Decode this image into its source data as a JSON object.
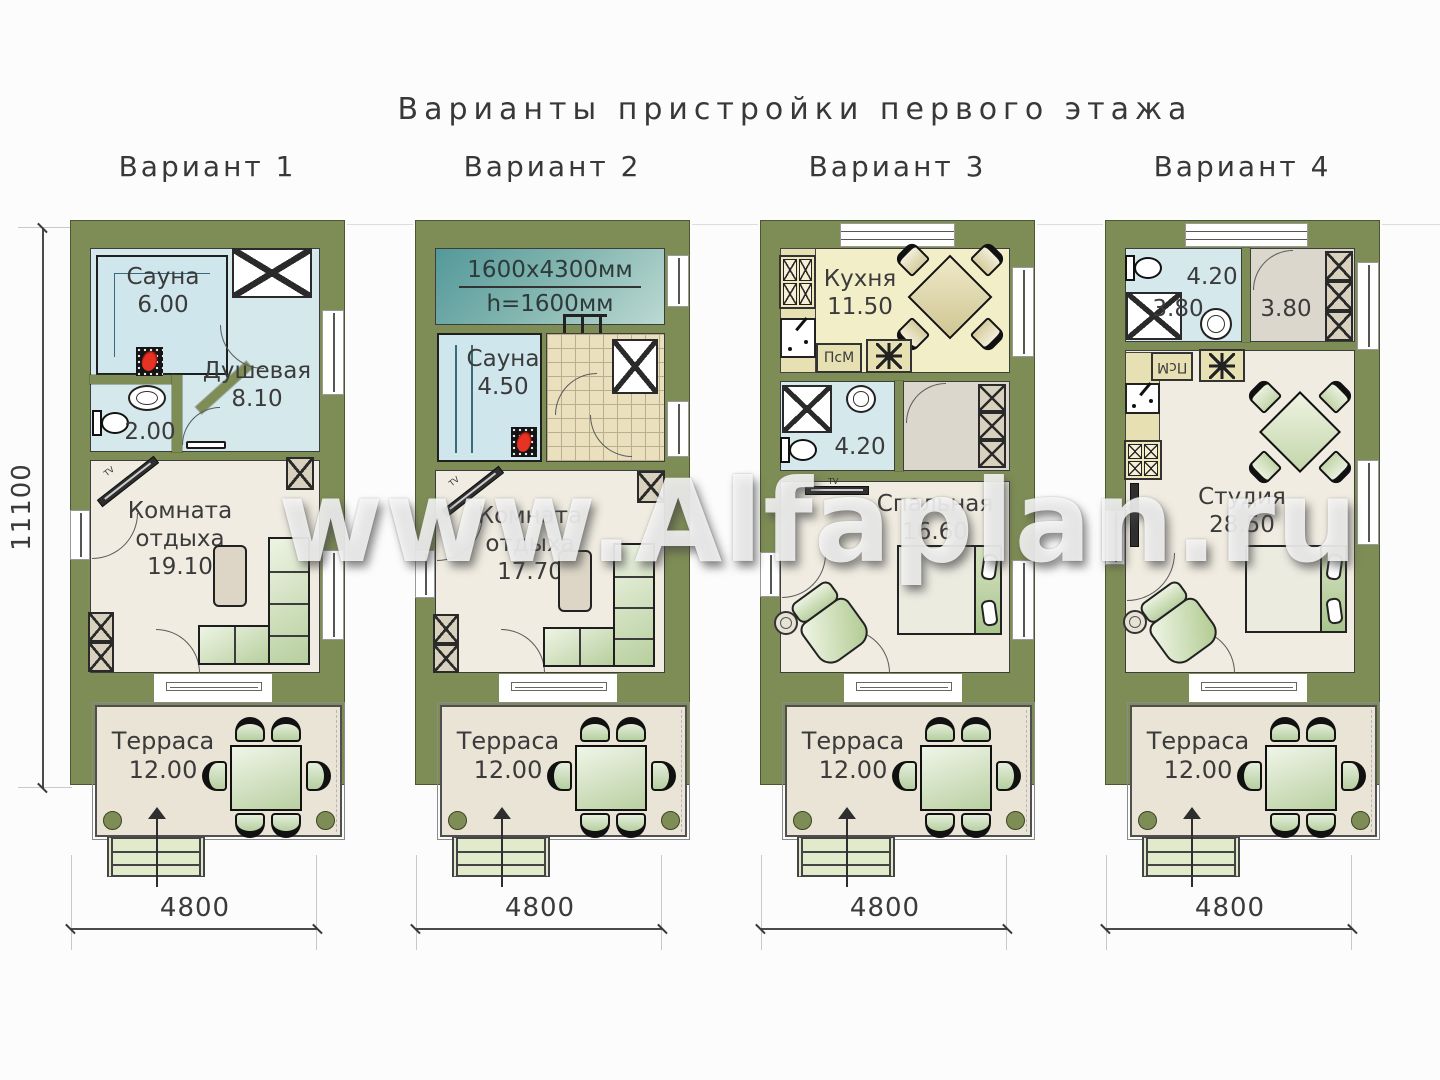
{
  "title": "Варианты пристройки первого этажа",
  "watermark": "www.Alfaplan.ru",
  "dimensions": {
    "height": "11100",
    "width": "4800"
  },
  "icons": {
    "washer": "eight-spoke-star",
    "entrance": "up-arrow",
    "tv": "wall-tv",
    "stove": "sauna-heater"
  },
  "variants": [
    {
      "label": "Вариант 1",
      "tv": "TV",
      "rooms": {
        "sauna": {
          "name": "Сауна",
          "area": "6.00"
        },
        "shower": {
          "name": "Душевая",
          "area": "8.10"
        },
        "wc": {
          "area": "2.00"
        },
        "lounge": {
          "name": "Комната отдыха",
          "area": "19.10"
        },
        "terrace": {
          "name": "Терраса",
          "area": "12.00"
        }
      }
    },
    {
      "label": "Вариант 2",
      "tv": "TV",
      "loft_note": {
        "line1": "1600x4300мм",
        "line2": "h=1600мм"
      },
      "rooms": {
        "sauna": {
          "name": "Сауна",
          "area": "4.50"
        },
        "lounge": {
          "name": "Комната отдыха",
          "area": "17.70"
        },
        "terrace": {
          "name": "Терраса",
          "area": "12.00"
        }
      }
    },
    {
      "label": "Вариант 3",
      "labels": {
        "psm": "ПсМ",
        "tv": "TV"
      },
      "rooms": {
        "kitchen": {
          "name": "Кухня",
          "area": "11.50"
        },
        "bathroom": {
          "area": "4.20"
        },
        "bedroom": {
          "name": "Спальная",
          "area": "16.60"
        },
        "terrace": {
          "name": "Терраса",
          "area": "12.00"
        }
      }
    },
    {
      "label": "Вариант 4",
      "labels": {
        "psm": "ПсМ",
        "tv": "TV"
      },
      "rooms": {
        "wc": {
          "area": "4.20"
        },
        "shower": {
          "area": "3.80"
        },
        "hall": {
          "area": "3.80"
        },
        "studio": {
          "name": "Студия",
          "area": "28.50"
        },
        "terrace": {
          "name": "Терраса",
          "area": "12.00"
        }
      }
    }
  ]
}
